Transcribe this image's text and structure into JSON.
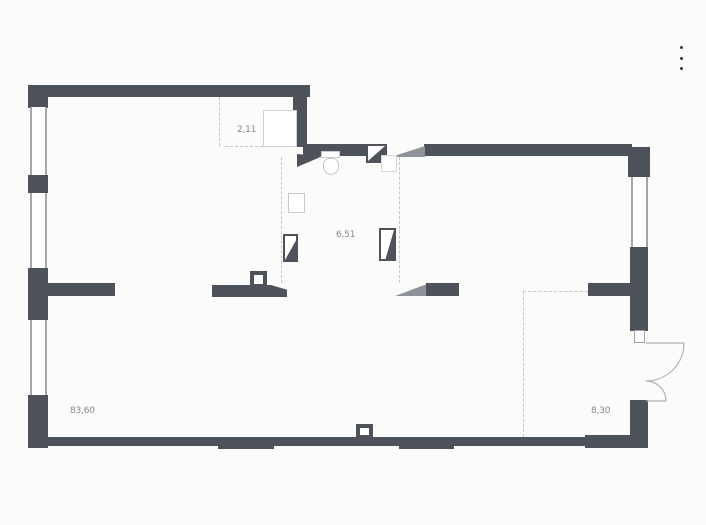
{
  "menu": {
    "icon": "kebab-menu-icon"
  },
  "floorplan": {
    "rooms": [
      {
        "id": "closet",
        "area_label": "2,11"
      },
      {
        "id": "corridor",
        "area_label": "6,51"
      },
      {
        "id": "living",
        "area_label": "83,60"
      },
      {
        "id": "entry",
        "area_label": "8,30"
      }
    ],
    "symbols": [
      "window",
      "door-leaf",
      "door-swing-arc",
      "dashed-zone-line",
      "toilet",
      "washer",
      "basin",
      "wardrobe"
    ],
    "colors": {
      "wall": "#4e525a",
      "fixture": "#c9cbce",
      "dash": "#c3c5c9",
      "label": "#84878d",
      "wedge": "#8f9297",
      "background": "#fbfbfa"
    }
  }
}
